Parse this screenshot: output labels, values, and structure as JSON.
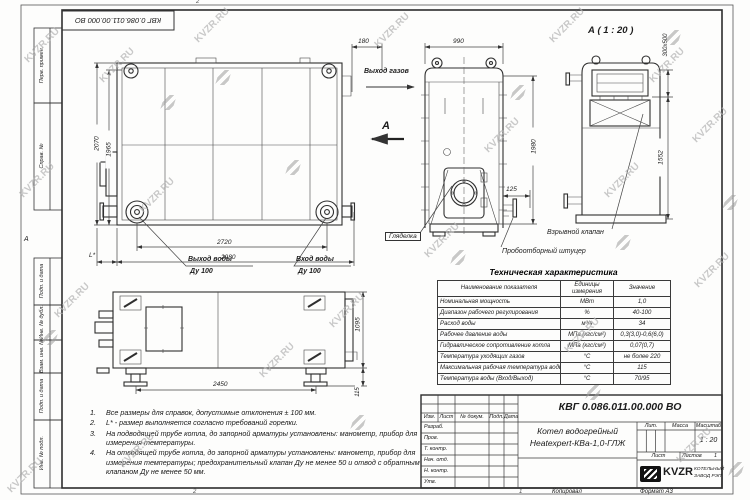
{
  "watermark": {
    "text": "KVZR.RU"
  },
  "frame": {
    "top_designation": "КВГ 0.086.011.00.000 ВО",
    "zone_mark": "А",
    "fold_mark_top": "2",
    "fold_mark_bottom": "2",
    "fold_mark_copy": "1",
    "left_fields": [
      "Перв. примен.",
      "Справ. №",
      "Подп. и дата",
      "Инв. № дубл.",
      "Взам. инв. №",
      "Подп. и дата",
      "Инв. № подл."
    ]
  },
  "views": {
    "front": {
      "dim_2070": "2070",
      "dim_1965": "1965",
      "dim_2720": "2720",
      "dim_2980": "2980",
      "dim_l": "L*",
      "dim_180": "180",
      "water_out_line1": "Выход воды",
      "water_out_line2": "Ду 100",
      "water_in_line1": "Вход воды",
      "water_in_line2": "Ду 100"
    },
    "side": {
      "dim_990": "990",
      "dim_1980": "1980",
      "dim_125": "125",
      "label_gas_out": "Выход газов",
      "section_letter": "А",
      "label_sight": "Гляделка",
      "label_sampling": "Пробоотборный штуцер"
    },
    "section_a": {
      "title": "А ( 1 : 20 )",
      "dim_300x500": "300х500",
      "dim_1552": "1552",
      "label_valve": "Взрывной клапан"
    },
    "top": {
      "dim_1095": "1095",
      "dim_2450": "2450",
      "dim_115": "115"
    }
  },
  "spec_table": {
    "title": "Техническая характеристика",
    "headers": [
      "Наименование показателя",
      "Единицы измерения",
      "Значение"
    ],
    "rows": [
      [
        "Номинальная мощность",
        "МВт",
        "1,0"
      ],
      [
        "Диапазон рабочего регулирования",
        "%",
        "40-100"
      ],
      [
        "Расход воды",
        "м³/ч",
        "34"
      ],
      [
        "Рабочее давление воды",
        "МПа (кгс/см²)",
        "0,3(3,0)-0,6(6,0)"
      ],
      [
        "Гидравлическое сопротивление котла",
        "МПа (кгс/см²)",
        "0,07(0,7)"
      ],
      [
        "Температура уходящих газов",
        "°С",
        "не более 220"
      ],
      [
        "Максимальная рабочая температура воды",
        "°С",
        "115"
      ],
      [
        "Температура воды (Вход/Выход)",
        "°С",
        "70/95"
      ]
    ]
  },
  "notes": [
    {
      "num": "1.",
      "text": "Все размеры для справок, допустимые отклонения ± 100 мм."
    },
    {
      "num": "2.",
      "text": "L* - размер выполняется согласно требований горелки."
    },
    {
      "num": "3.",
      "text": "На подводящей трубе котла, до запорной арматуры установлены: манометр, прибор для измерения температуры."
    },
    {
      "num": "4.",
      "text": "На отводящей трубе котла, до запорной арматуры установлены: манометр, прибор для измерения температуры; предохранительный клапан Ду не менее 50 и отвод с обратным клапаном Ду не менее 50 мм."
    }
  ],
  "title_block": {
    "designation": "КВГ 0.086.011.00.000 ВО",
    "name_line1": "Котел водогрейный",
    "name_line2": "Heatexpert-КВа-1,0-ГЛЖ",
    "header_cols": [
      "Изм.",
      "Лист",
      "№ докум.",
      "Подп.",
      "Дата"
    ],
    "row_labels": [
      "Разраб.",
      "Пров.",
      "Т. контр.",
      "Нач. отд.",
      "Н. контр.",
      "Утв."
    ],
    "lit_label": "Лит.",
    "mass_label": "Масса",
    "scale_label": "Масштаб",
    "scale_value": "1 : 20",
    "sheet_label": "Лист",
    "sheets_label": "Листов",
    "sheets_value": "1",
    "company_abbr": "KVZR",
    "company_line1": "КОТЕЛЬНЫЙ",
    "company_line2": "ЗАВОД РЭП",
    "footer_copy": "Копировал",
    "footer_format": "Формат А3"
  }
}
